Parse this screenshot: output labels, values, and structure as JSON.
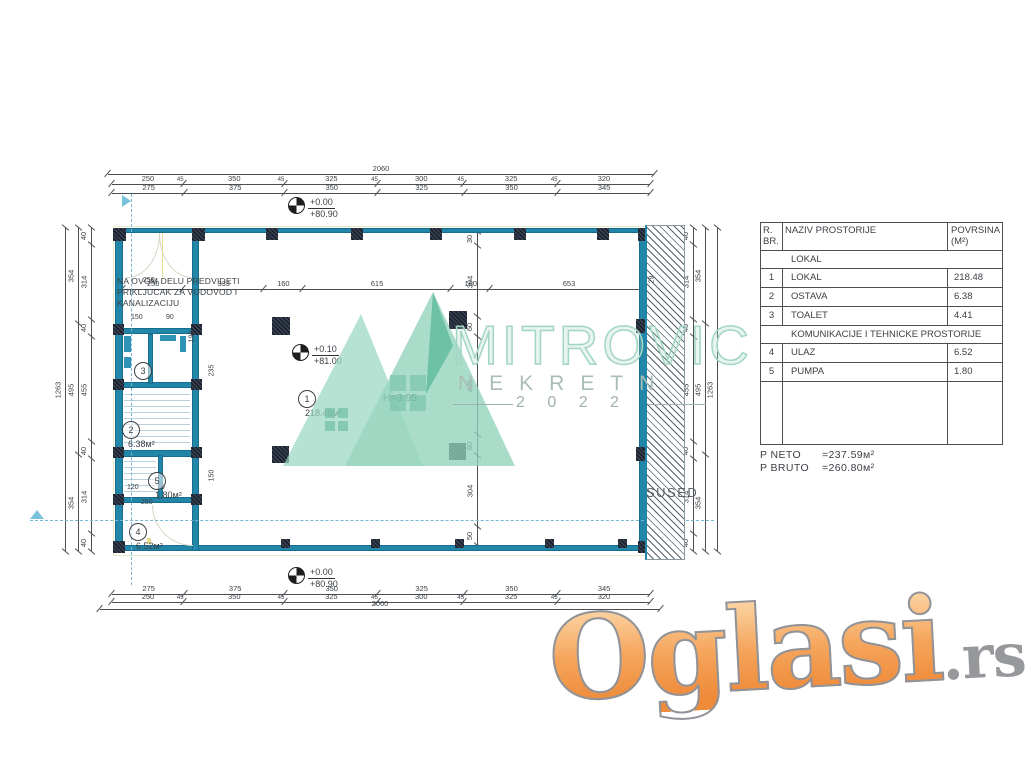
{
  "colors": {
    "wall_teal": "#2186a8",
    "column_dark": "#1b2332",
    "watermark_green": "#8fd2ba",
    "logo_orange": "#f09045",
    "hatch_gray": "#55606a",
    "section_dashed_blue": "#74b6d4"
  },
  "plan": {
    "note_lines": [
      "NA OVOM DELU PREDVIDETI",
      "PRIKLJUCAK ZA VODOVOD I",
      "KANALIZACIJU"
    ],
    "labels": {
      "sused": "SUSED",
      "height": "H=3.95"
    },
    "elevation": {
      "top": [
        "+0.00",
        "+80.90"
      ],
      "interior": [
        "+0.10",
        "+81.00"
      ],
      "bottom": [
        "+0.00",
        "+80.90"
      ]
    },
    "rooms": [
      {
        "num": "1",
        "area": "218.48м²"
      },
      {
        "num": "2",
        "area": "6.38м²"
      },
      {
        "num": "3",
        "area": ""
      },
      {
        "num": "4",
        "area": "6.52м²"
      },
      {
        "num": "5",
        "area": "1.80м²"
      }
    ],
    "dims": {
      "total": "2060",
      "row_250": [
        "250",
        "350",
        "325",
        "300",
        "325",
        "320"
      ],
      "row_275": [
        "275",
        "375",
        "350",
        "325",
        "350",
        "345"
      ],
      "tick": "45",
      "interior": [
        "250",
        "333",
        "160",
        "615",
        "160",
        "653"
      ],
      "interior_end": "29",
      "v_total": "1263",
      "v_mid": [
        "354",
        "495",
        "354"
      ],
      "v_inner": [
        "40",
        "314",
        "40",
        "455",
        "40",
        "314",
        "40"
      ],
      "v_center": [
        "30",
        "304",
        "60",
        "435",
        "60",
        "304",
        "50"
      ],
      "wing_small": [
        "250",
        "150",
        "90",
        "190",
        "235",
        "150",
        "120",
        "20",
        "250"
      ]
    }
  },
  "table": {
    "header": {
      "col1a": "R.",
      "col1b": "BR.",
      "col2": "NAZIV PROSTORIJE",
      "col3a": "POVRSINA",
      "col3b": "(M²)"
    },
    "rows": [
      {
        "type": "section",
        "label": "LOKAL"
      },
      {
        "type": "item",
        "num": "1",
        "name": "LOKAL",
        "area": "218.48"
      },
      {
        "type": "item",
        "num": "2",
        "name": "OSTAVA",
        "area": "6.38"
      },
      {
        "type": "item",
        "num": "3",
        "name": "TOALET",
        "area": "4.41"
      },
      {
        "type": "section",
        "label": "KOMUNIKACIJE I TEHNICKE PROSTORIJE"
      },
      {
        "type": "item",
        "num": "4",
        "name": "ULAZ",
        "area": "6.52"
      },
      {
        "type": "item",
        "num": "5",
        "name": "PUMPA",
        "area": "1.80"
      },
      {
        "type": "empty"
      }
    ]
  },
  "summary": {
    "neto_label": "P NETO",
    "neto_value": "=237.59м²",
    "bruto_label": "P BRUTO",
    "bruto_value": "=260.80м²"
  },
  "watermark": {
    "brand": "MITROVIC",
    "sub": "NEKRETN",
    "year": "2 0 2 2"
  },
  "logo": {
    "main": "Oglasi",
    "suffix": ".rs"
  }
}
